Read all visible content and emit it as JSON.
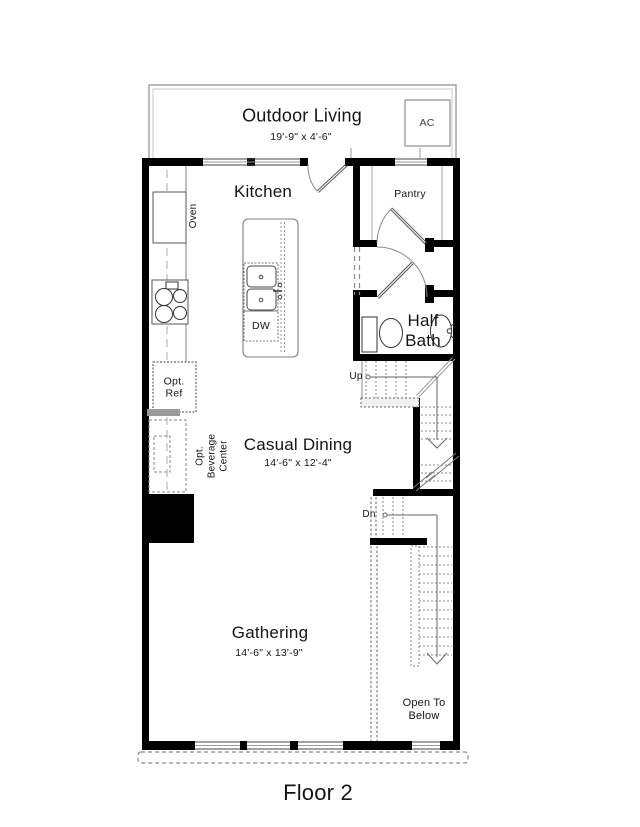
{
  "plan": {
    "floor_label": "Floor 2",
    "rooms": {
      "outdoor_living": {
        "name": "Outdoor Living",
        "dims": "19'-9\" x 4'-6\""
      },
      "kitchen": {
        "name": "Kitchen"
      },
      "pantry": {
        "name": "Pantry"
      },
      "half_bath": {
        "name": "Half\nBath"
      },
      "casual_dining": {
        "name": "Casual Dining",
        "dims": "14'-6\" x 12'-4\""
      },
      "gathering": {
        "name": "Gathering",
        "dims": "14'-6\" x 13'-9\""
      },
      "open_to_below": {
        "name": "Open To\nBelow"
      }
    },
    "fixtures": {
      "ac": "AC",
      "oven": "Oven",
      "dishwasher": "DW",
      "opt_ref": "Opt.\nRef",
      "opt_beverage": "Opt.\nBeverage\nCenter"
    },
    "stairs": {
      "up": "Up",
      "dn": "Dn"
    },
    "colors": {
      "wall": "#000000",
      "line": "#8a8a8a",
      "text": "#151515"
    }
  }
}
